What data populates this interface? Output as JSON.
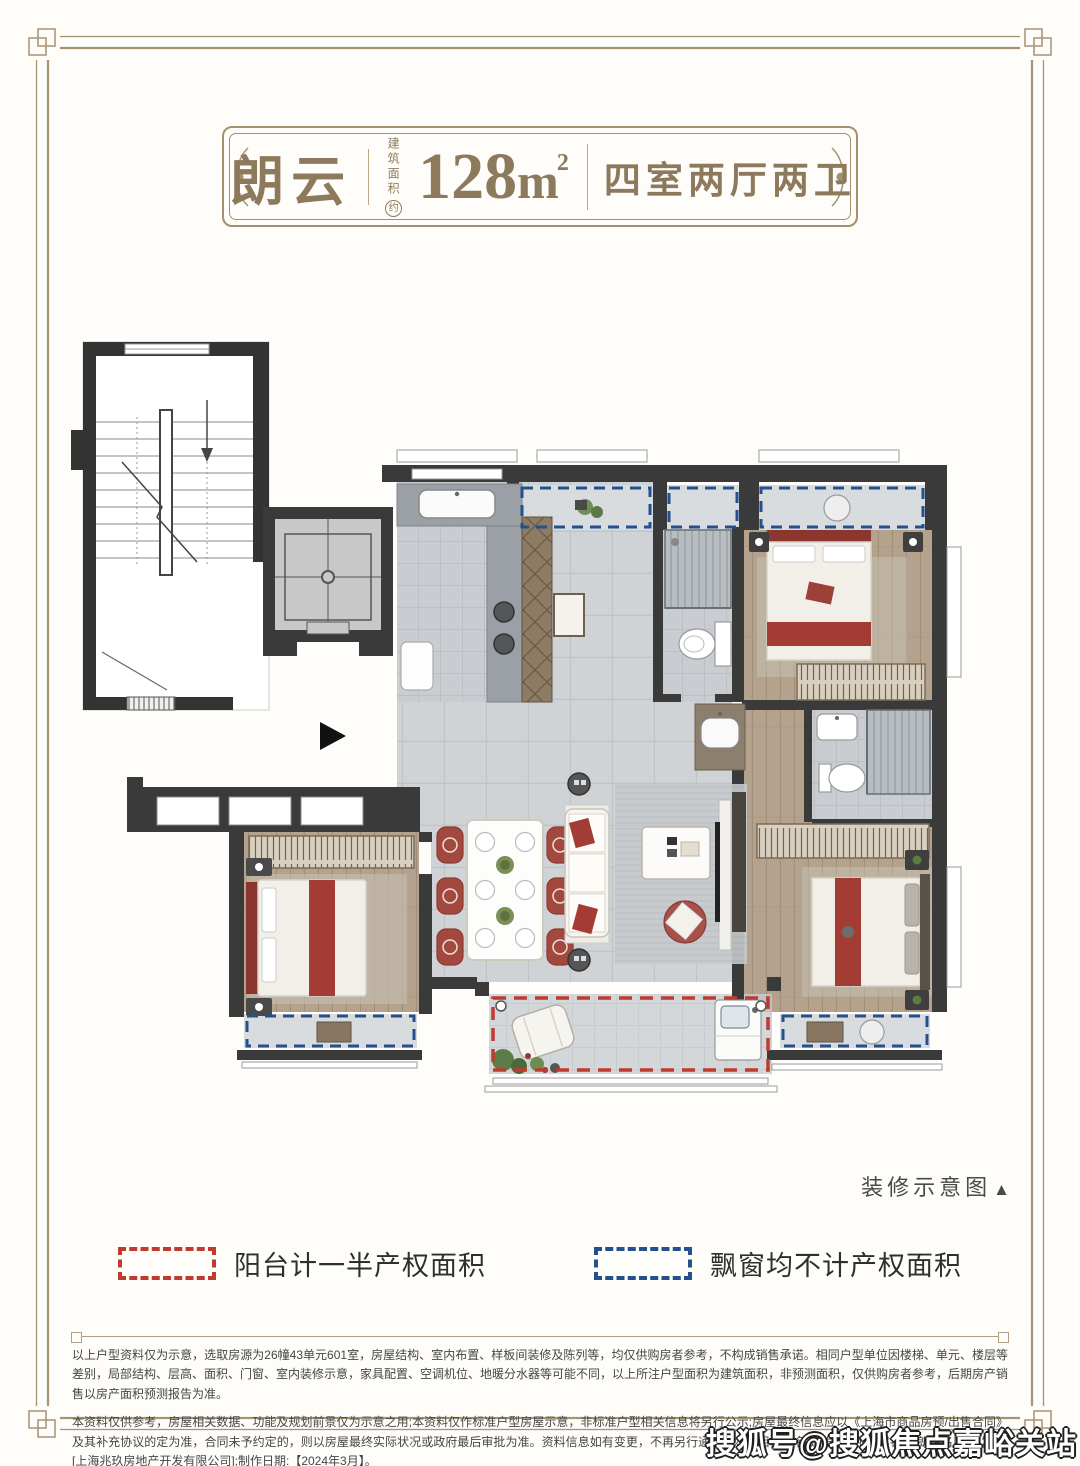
{
  "header": {
    "name": "朗云",
    "area_label": "建筑面积",
    "area_approx": "约",
    "area_value": "128",
    "area_unit": "m",
    "area_sup": "2",
    "layout": "四室两厅两卫"
  },
  "caption": {
    "text": "装修示意图",
    "arrow": "▲"
  },
  "legend": {
    "items": [
      {
        "label": "阳台计一半产权面积",
        "color": "#bf3a2f",
        "style": "dashed"
      },
      {
        "label": "飘窗均不计产权面积",
        "color": "#24508e",
        "style": "dashed"
      }
    ]
  },
  "disclaimer": {
    "p1": "以上户型资料仅为示意，选取房源为26幢43单元601室，房屋结构、室内布置、样板间装修及陈列等，均仅供购房者参考，不构成销售承诺。相同户型单位因楼梯、单元、楼层等差别，局部结构、层高、面积、门窗、室内装修示意，家具配置、空调机位、地暖分水器等可能不同，以上所注户型面积为建筑面积，非预测面积，仅供购房者参考，后期房产销售以房产面积预测报告为准。",
    "p2": "本资料仅供参考，房屋相关数据、功能及规划前景仅为示意之用;本资料仅作标准户型房屋示意，非标准户型相关信息将另行公示;房屋最终信息应以《上海市商品房预/出售合同》及其补充协议的定为准，合同未予约定的，则以房屋最终实际状况或政府最后审批为准。资料信息如有变更，不再另行通知。本项目推广名[建发·朗玥]备案名为[朗玥名庭]开发商:[上海兆玖房地产开发有限公司];制作日期:【2024年3月】。"
  },
  "watermark": "搜狐号@搜狐焦点嘉峪关站",
  "colors": {
    "frame_gold": "#a89272",
    "header_text": "#8d7a5c",
    "balcony_red": "#bf3a2f",
    "baywindow_blue": "#24508e",
    "wall_dark": "#3a3a3a"
  }
}
